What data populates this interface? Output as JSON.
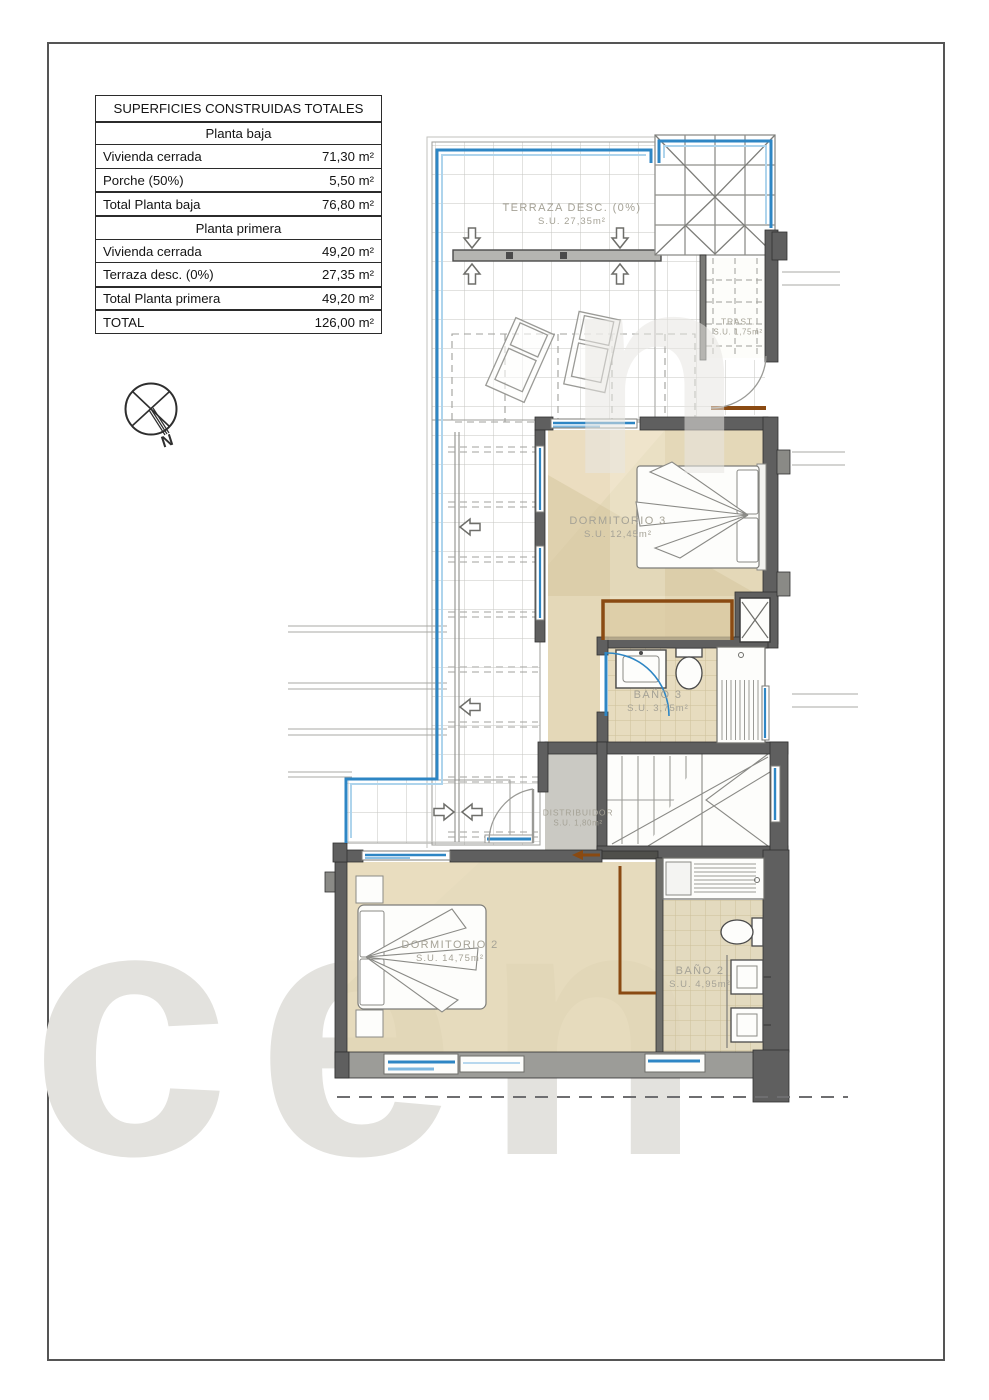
{
  "table": {
    "title": "SUPERFICIES CONSTRUIDAS TOTALES",
    "sections": [
      {
        "header": "Planta baja",
        "rows": [
          [
            "Vivienda cerrada",
            "71,30 m²"
          ],
          [
            "Porche (50%)",
            "5,50 m²"
          ]
        ],
        "total": [
          "Total Planta baja",
          "76,80 m²"
        ]
      },
      {
        "header": "Planta primera",
        "rows": [
          [
            "Vivienda cerrada",
            "49,20 m²"
          ],
          [
            "Terraza desc. (0%)",
            "27,35 m²"
          ]
        ],
        "total": [
          "Total Planta primera",
          "49,20 m²"
        ]
      }
    ],
    "grand_total": [
      "TOTAL",
      "126,00 m²"
    ]
  },
  "compass": {
    "label": "N"
  },
  "rooms": [
    {
      "name": "TERRAZA DESC. (0%)",
      "area": "S.U. 27,35m²"
    },
    {
      "name": "TRAST.",
      "area": "S.U. 1,75m²"
    },
    {
      "name": "DORMITORIO 3",
      "area": "S.U. 12,45m²"
    },
    {
      "name": "BAÑO 3",
      "area": "S.U. 3,75m²"
    },
    {
      "name": "DISTRIBUIDOR",
      "area": "S.U. 1,80m²"
    },
    {
      "name": "DORMITORIO 2",
      "area": "S.U. 14,75m²"
    },
    {
      "name": "BAÑO 2",
      "area": "S.U. 4,95m²"
    }
  ],
  "watermark": {
    "text": "cen",
    "fragment": "n"
  },
  "colors": {
    "accent_blue": "#2e86c4",
    "light_blue": "#aed4ec",
    "wall_gray": "#5f5f5f",
    "floor_beige": "#e2d5b2",
    "tile_line": "#c6c6c2",
    "wood_brown": "#8a4a12"
  }
}
